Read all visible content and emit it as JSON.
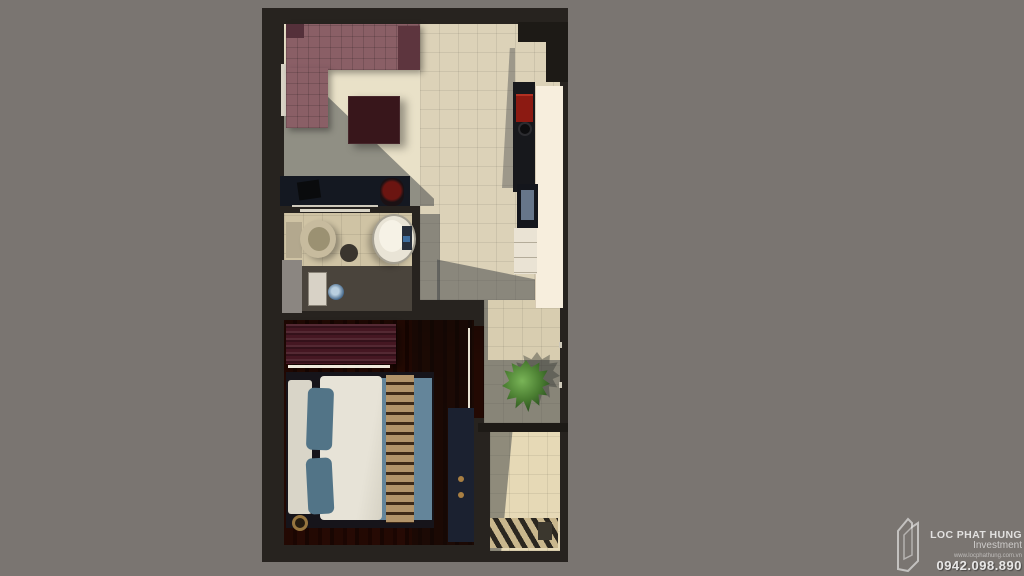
{
  "watermark": {
    "brand": "LOC PHAT HUNG",
    "subtitle": "Investment",
    "website": "www.locphathung.com.vn",
    "phone": "0942.098.890"
  },
  "palette": {
    "background": "#7a7571",
    "walls": "#27231f",
    "living_floor": "#e9e1c8",
    "kitchen_tile": "#dcd2b8",
    "bath_tile": "#cfc3a4",
    "shower_floor": "#4a443c",
    "wood_floor": "#5a2e1c",
    "sofa_fabric": "#8a5f66",
    "coffee_table": "#38161b",
    "wardrobe": "#451722",
    "bed_duvet": "#e7e3d7",
    "bed_blanket": "#64859a",
    "kitchen_counter": "#f7eedd",
    "stove_red": "#8c1a12",
    "plant_green": "#4a7d31",
    "shadow": "rgba(64,68,69,0.52)"
  }
}
